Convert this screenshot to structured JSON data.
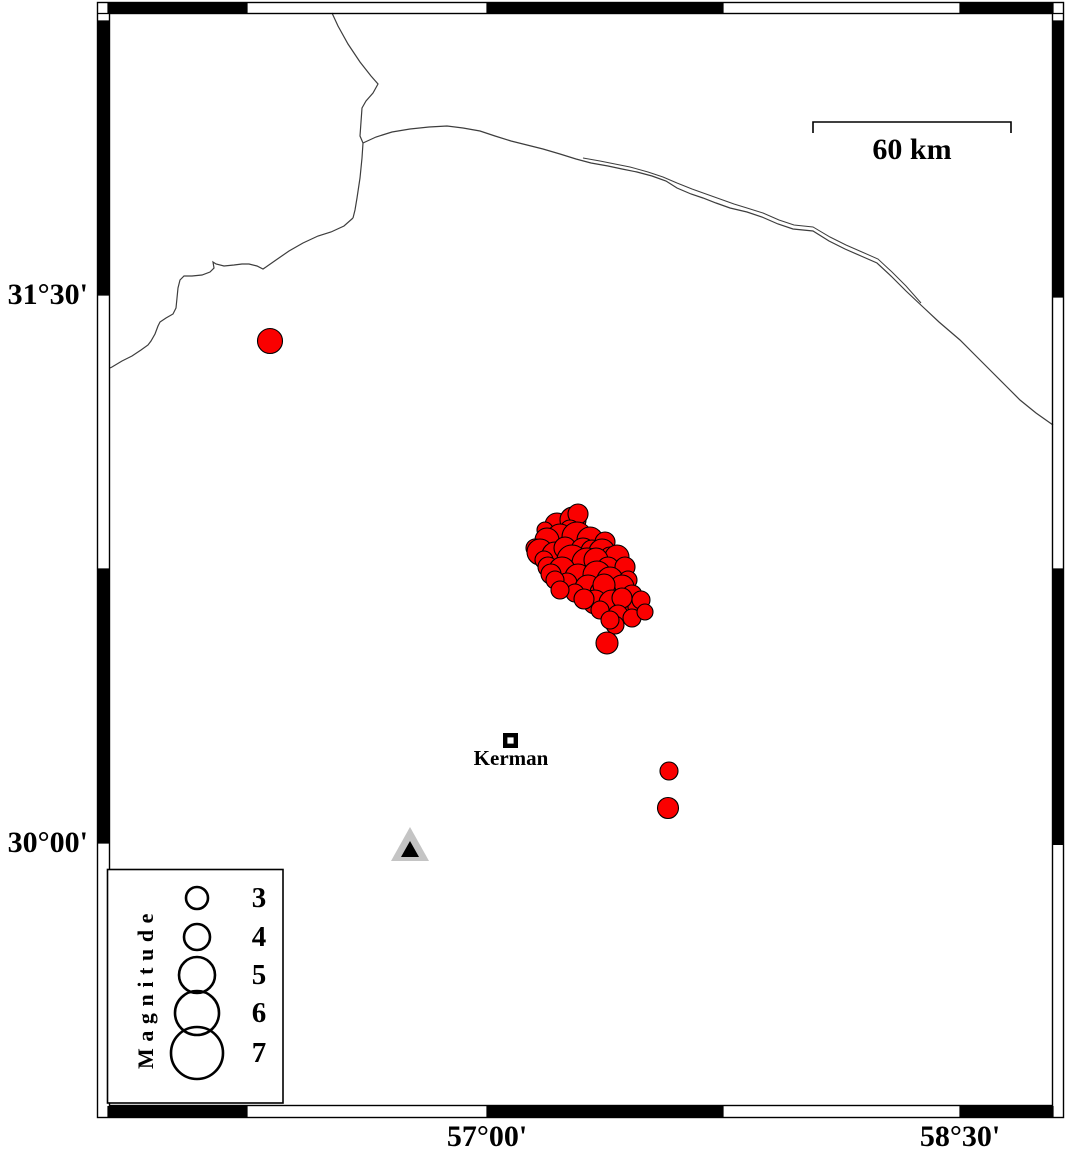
{
  "axis": {
    "left_labels": [
      {
        "label": "31°30'"
      },
      {
        "label": "30°00'"
      }
    ],
    "bottom_labels": [
      {
        "label": "57°00'"
      },
      {
        "label": "58°30'"
      }
    ]
  },
  "scale_bar": {
    "label": "60 km"
  },
  "city": {
    "label": "Kerman"
  },
  "legend": {
    "title": "Magnitude",
    "circle_cx": 197,
    "entries": [
      {
        "label": "3",
        "r": 11,
        "cy": 898
      },
      {
        "label": "4",
        "r": 13,
        "cy": 937
      },
      {
        "label": "5",
        "r": 18,
        "cy": 975
      },
      {
        "label": "6",
        "r": 22,
        "cy": 1013
      },
      {
        "label": "7",
        "r": 26,
        "cy": 1053
      }
    ]
  },
  "colors": {
    "earthquake_fill": "#fa0000",
    "outline": "#000000",
    "station_outer": "#c4c4c4",
    "station_inner": "#000000",
    "boundary_line": "#3d3d3d"
  },
  "station": {
    "x": 410,
    "y": 847
  },
  "city_marker": {
    "x": 510.5,
    "y": 740.5
  },
  "map_lines": {
    "border": "332,13 338,26 348,44 360,62 371,76 378,84 373,93 366,101 362,108 361,122 360,136 363,143 362,158 360,178 357,198 355,210 353,218",
    "coast": "353,218 344,226 331,232 318,236 303,243 289,251 276,260 266,267 263,269 257,266 249,264 242,264 234,265 224,266 216,264 213,262 214,268 210,272 202,275 192,276 184,276 180,280 178,288 177,298 176,308 173,314 166,318 160,322 158,326 155,334 151,341 148,345 141,350 132,356 122,361 112,367 110,368",
    "road_main": "363,143 376,137 392,132 410,129 429,127 447,126 463,128 480,131 495,136 511,141 527,145 543,149 560,154 576,159 591,163 608,166 622,169 637,172 652,176 666,181 677,188 691,194 703,198 716,203 730,208 747,212 762,217 778,224 793,229 813,231 829,241 845,249 861,256 877,263 891,276 906,291 923,307 939,322 960,340 976,356 991,371 1006,386 1020,400 1036,413 1053,425",
    "road_pair": "583,158 600,161 615,164 630,167 648,172 663,177 677,183 692,189 706,194 720,199 734,204 747,208 763,213 779,220 794,225 813,227 830,237 846,245 862,252 878,259 892,272 906,286 921,303"
  },
  "earthquakes": {
    "points": [
      [
        270,
        341,
        12.5
      ],
      [
        557,
        525,
        12
      ],
      [
        573,
        520,
        13
      ],
      [
        578,
        514,
        10
      ],
      [
        570,
        530,
        10
      ],
      [
        545,
        530,
        8
      ],
      [
        560,
        537,
        13
      ],
      [
        547,
        540,
        12
      ],
      [
        577,
        537,
        15
      ],
      [
        590,
        540,
        13
      ],
      [
        605,
        542,
        10
      ],
      [
        535,
        548,
        9
      ],
      [
        540,
        552,
        13
      ],
      [
        555,
        555,
        13
      ],
      [
        565,
        548,
        11
      ],
      [
        583,
        550,
        12
      ],
      [
        592,
        551,
        11
      ],
      [
        602,
        552,
        13
      ],
      [
        610,
        557,
        10
      ],
      [
        617,
        557,
        12
      ],
      [
        544,
        560,
        9
      ],
      [
        572,
        560,
        15
      ],
      [
        587,
        563,
        15
      ],
      [
        596,
        560,
        12
      ],
      [
        548,
        567,
        10
      ],
      [
        562,
        570,
        13
      ],
      [
        608,
        568,
        11
      ],
      [
        625,
        567,
        10
      ],
      [
        551,
        574,
        10
      ],
      [
        578,
        577,
        13
      ],
      [
        597,
        575,
        14
      ],
      [
        610,
        580,
        13
      ],
      [
        567,
        583,
        10
      ],
      [
        555,
        580,
        9
      ],
      [
        628,
        580,
        9
      ],
      [
        588,
        588,
        13
      ],
      [
        622,
        587,
        12
      ],
      [
        603,
        593,
        13
      ],
      [
        632,
        595,
        10
      ],
      [
        575,
        593,
        9
      ],
      [
        604,
        585,
        11
      ],
      [
        560,
        590,
        9
      ],
      [
        595,
        602,
        12
      ],
      [
        612,
        603,
        13
      ],
      [
        625,
        608,
        11
      ],
      [
        637,
        607,
        9
      ],
      [
        641,
        600,
        9
      ],
      [
        584,
        599,
        10
      ],
      [
        622,
        598,
        10
      ],
      [
        618,
        615,
        10
      ],
      [
        632,
        618,
        9
      ],
      [
        645,
        612,
        8
      ],
      [
        615,
        625,
        9
      ],
      [
        600,
        610,
        9
      ],
      [
        610,
        620,
        9
      ],
      [
        607,
        643,
        11
      ],
      [
        669,
        771,
        9
      ],
      [
        668,
        808,
        10.5
      ]
    ]
  }
}
